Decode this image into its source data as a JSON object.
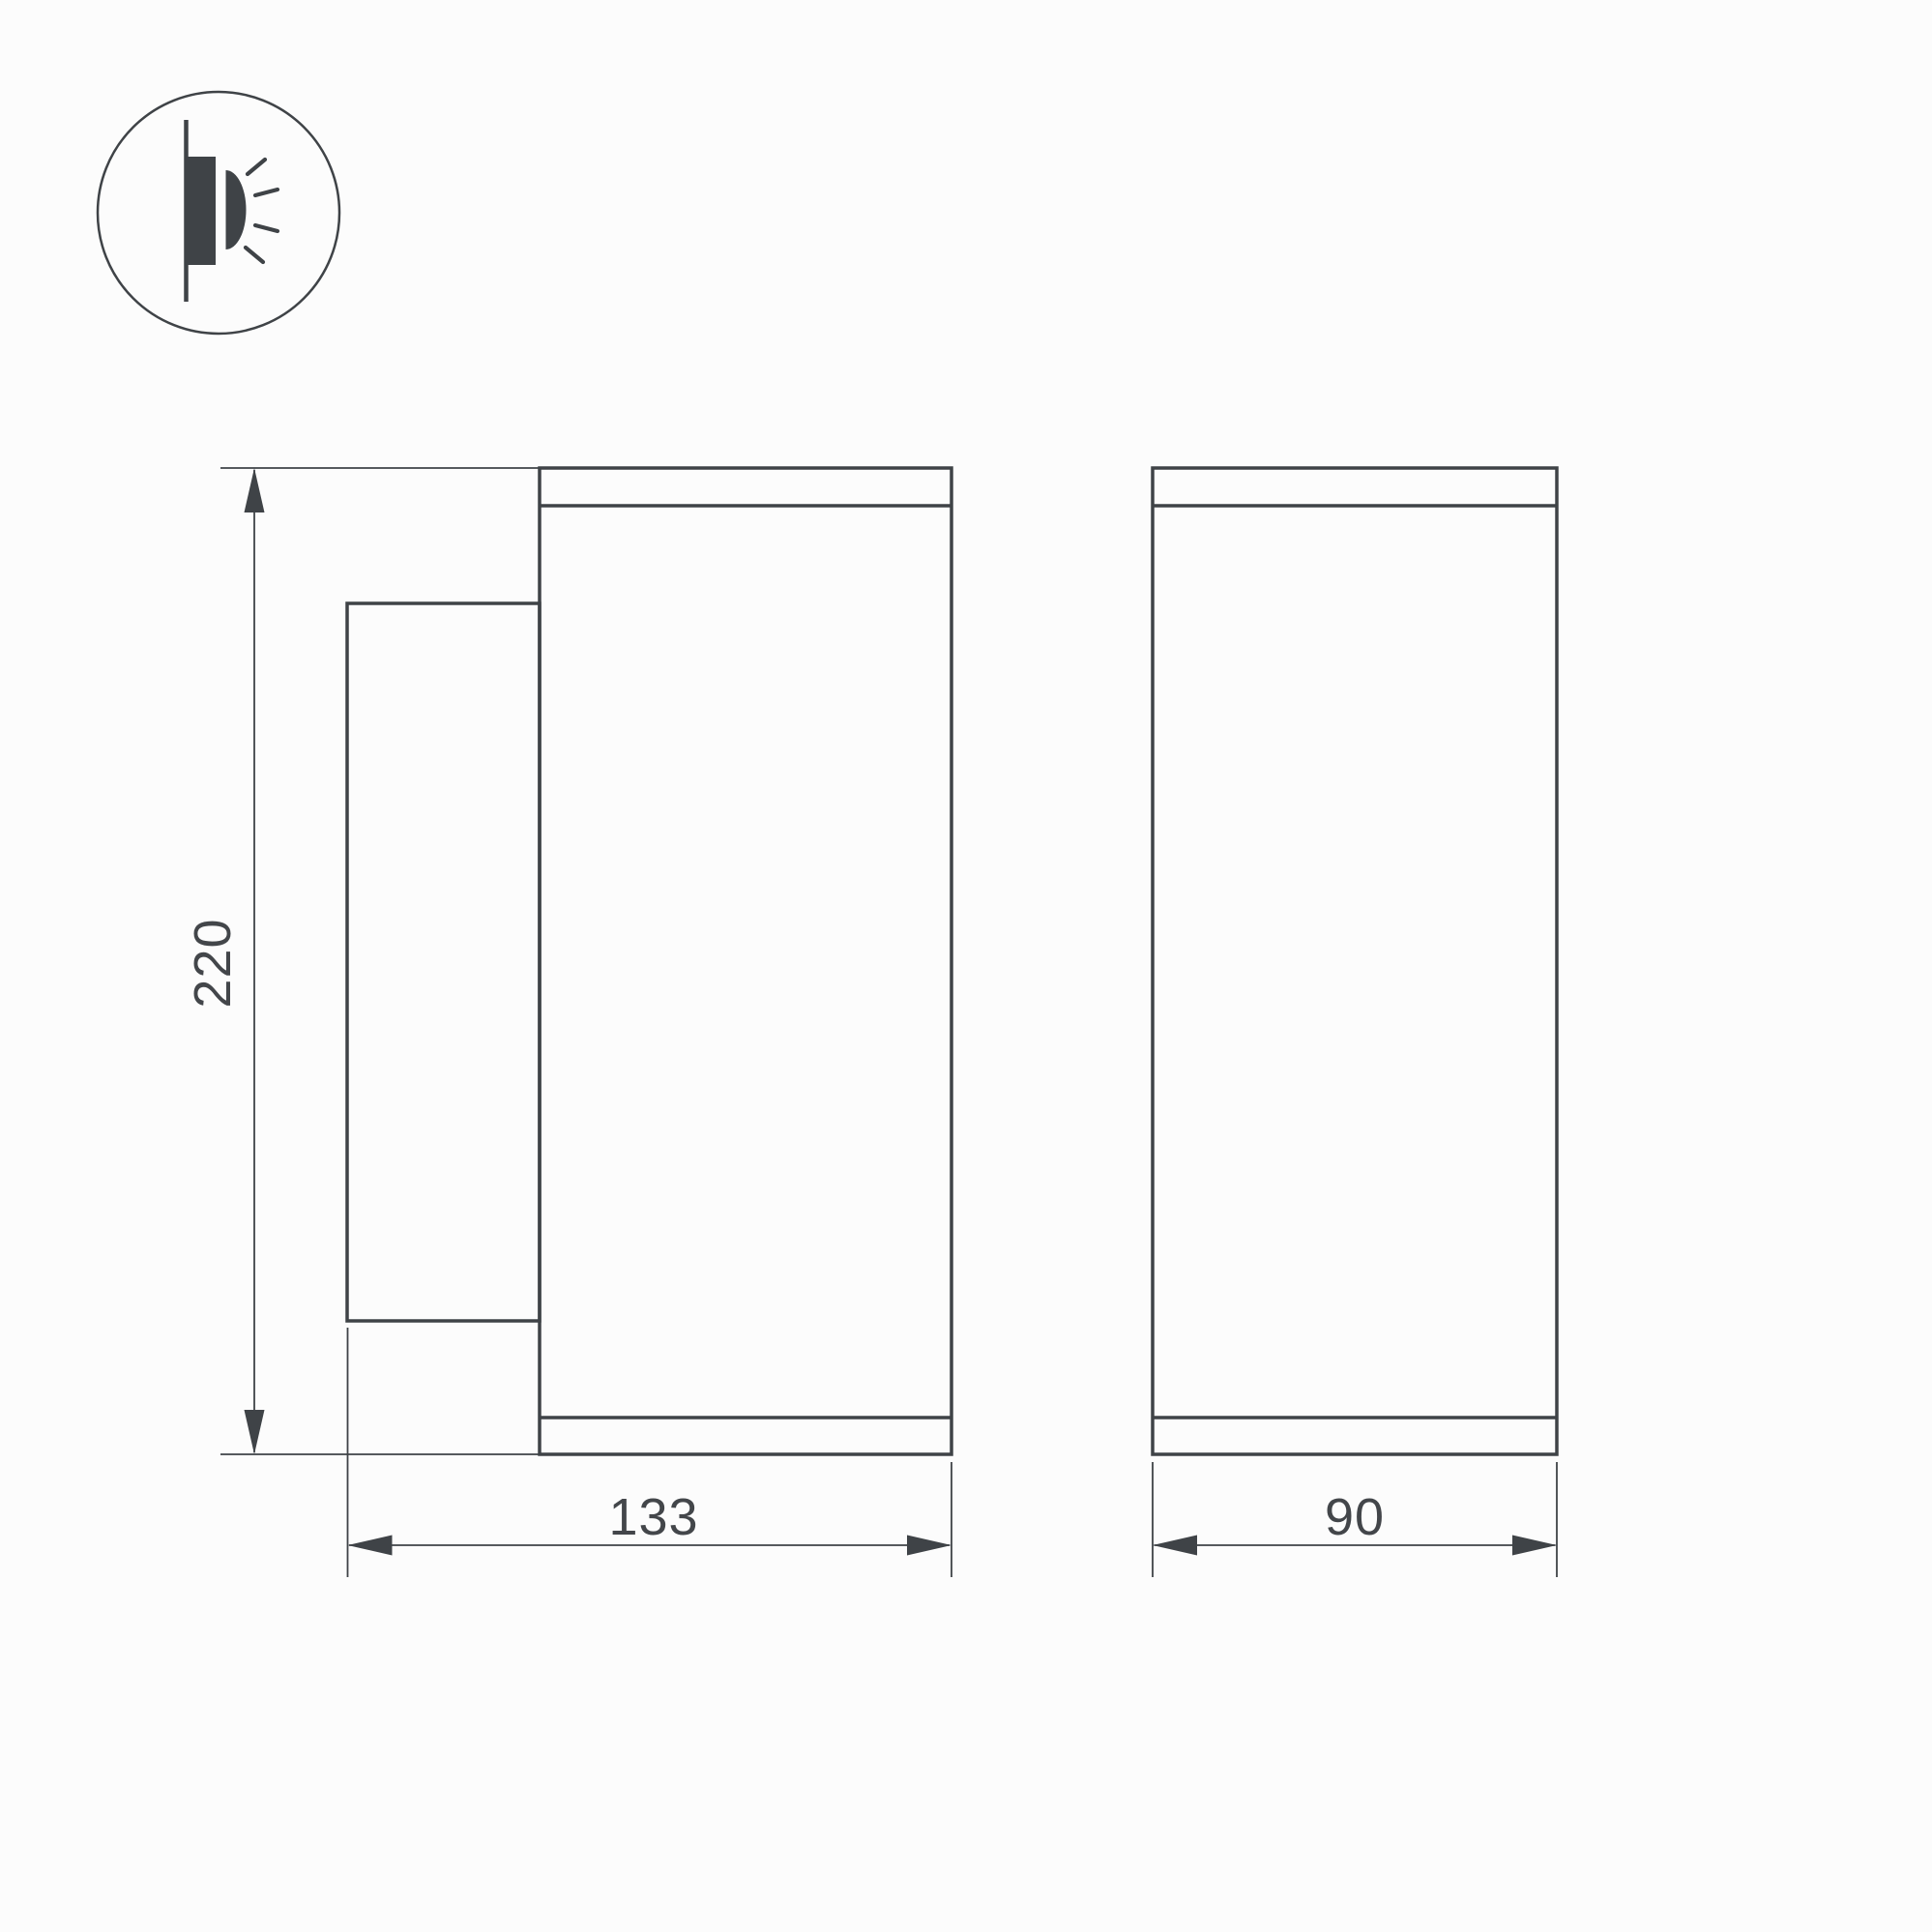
{
  "drawing": {
    "kind": "luminaire-dimension-drawing",
    "colors": {
      "line": "#3f4347",
      "text": "#43464a",
      "background": "#fcfcfc"
    },
    "icon": {
      "name": "wall-mounted-light",
      "meaning": "surface wall-mount fixture emitting light sideways"
    },
    "dimensions": {
      "height": {
        "label": "220",
        "orientation": "vertical",
        "view": "side"
      },
      "depth": {
        "label": "133",
        "orientation": "horizontal",
        "view": "side"
      },
      "width": {
        "label": "90",
        "orientation": "horizontal",
        "view": "front"
      }
    }
  }
}
